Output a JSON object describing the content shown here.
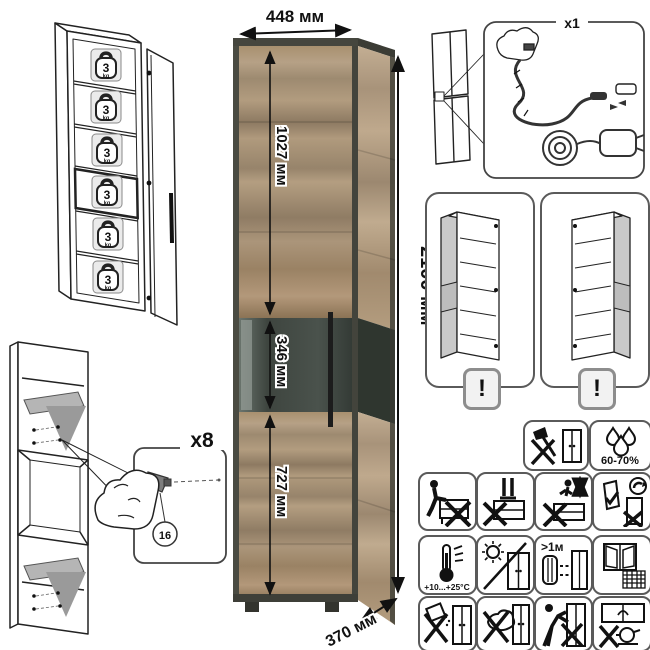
{
  "product_photo": {
    "width_label": "448 мм",
    "height_label": "2100 мм",
    "depth_label": "370 мм",
    "sections": {
      "upper": "1027 мм",
      "middle": "346 мм",
      "lower": "727 мм"
    },
    "colors": {
      "wood_light": "#b6a085",
      "wood_dark": "#8c775d",
      "frame": "#45463e",
      "glass": "#454c46",
      "handle": "#1c1c1c"
    }
  },
  "shelf_load": {
    "value": "3",
    "unit": "kg",
    "badge_count": 6
  },
  "led_kit": {
    "quantity_label": "x1"
  },
  "shelf_pins": {
    "quantity_label": "x8",
    "part_number": "16"
  },
  "door_reversible": {
    "warning_mark": "!"
  },
  "care_symbols": {
    "humidity": "60-70%",
    "temperature_range": "+10...+25°C",
    "min_heat_distance": ">1м"
  }
}
